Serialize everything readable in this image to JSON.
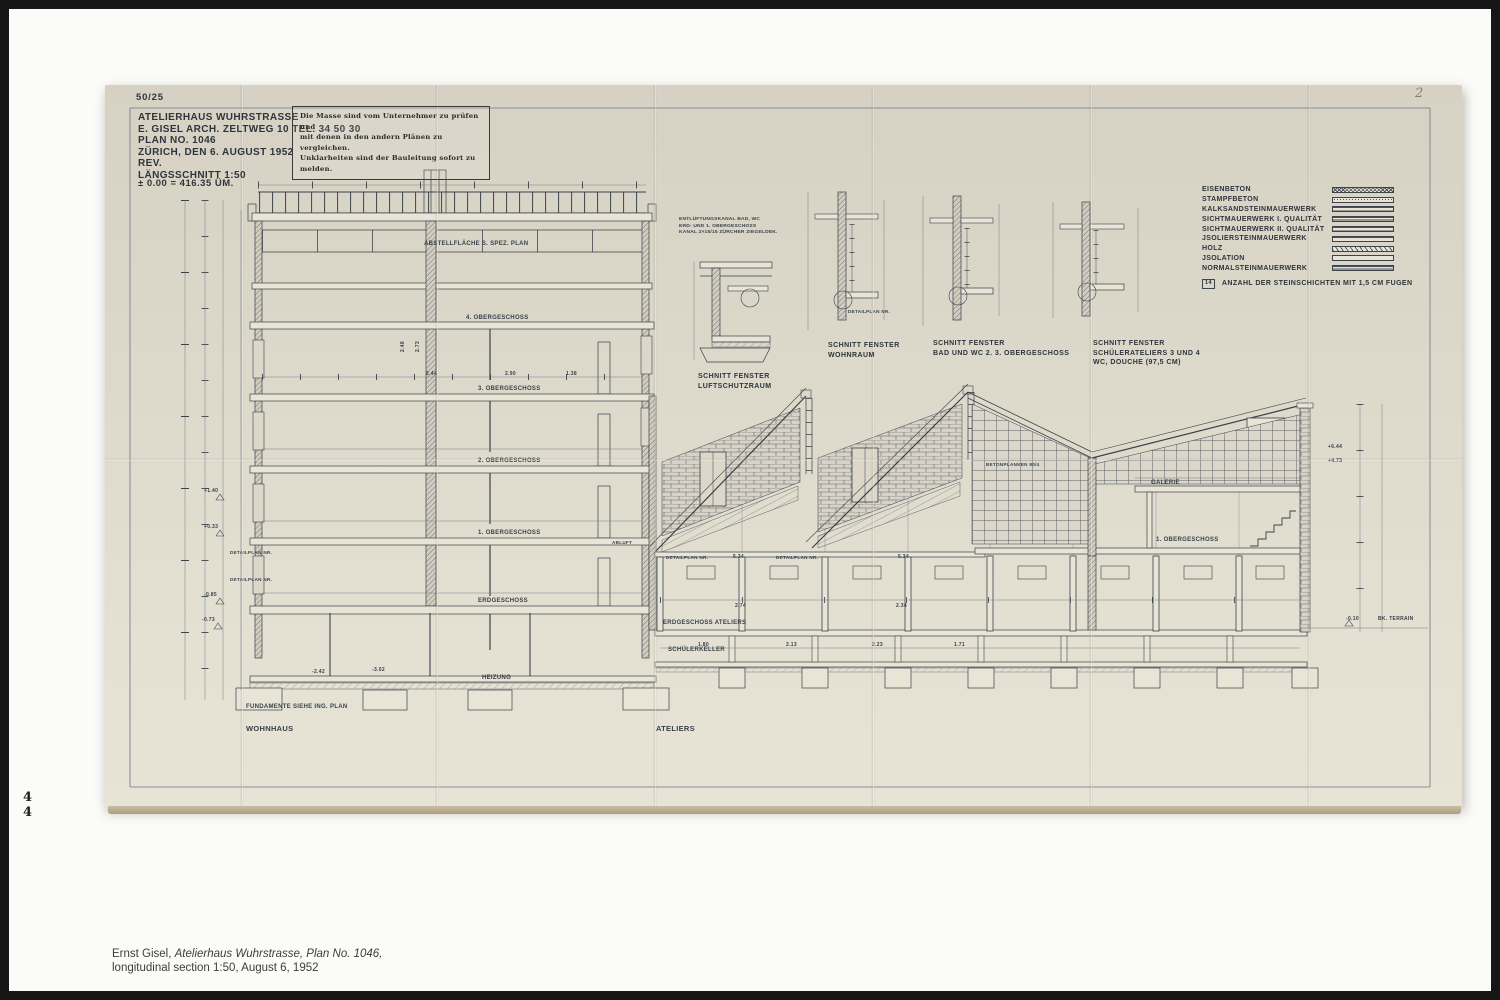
{
  "page": {
    "numbers": [
      "4",
      "4"
    ],
    "caption": {
      "author": "Ernst Gisel, ",
      "work_italic": "Atelierhaus Wuhrstrasse, Plan No. 1046,",
      "line2": "longitudinal section 1:50, August 6, 1952"
    }
  },
  "sheet": {
    "archive_no": "50/25",
    "corner_mark": "2",
    "title_block": {
      "lines": [
        "ATELIERHAUS WUHRSTRASSE",
        "E. GISEL ARCH. ZELTWEG 10    TEL. 34 50 30",
        "PLAN NO.  1046",
        "ZÜRICH, DEN   6. AUGUST  1952",
        "REV.",
        "LÄNGSSCHNITT   1:50"
      ],
      "datum": "± 0.00 = 416.35  ÜM."
    },
    "stamp": {
      "lines": [
        "Die Masse sind vom Unternehmer zu prüfen und",
        "mit denen in den andern Plänen zu vergleichen.",
        "Unklarheiten sind der Bauleitung sofort zu melden."
      ]
    },
    "legend": {
      "items": [
        {
          "label": "EISENBETON",
          "pattern": "cross"
        },
        {
          "label": "STAMPFBETON",
          "pattern": "stipple"
        },
        {
          "label": "KALKSANDSTEINMAUERWERK",
          "pattern": "h3"
        },
        {
          "label": "SICHTMAUERWERK   I. QUALITÄT",
          "pattern": "h2"
        },
        {
          "label": "SICHTMAUERWERK  II. QUALITÄT",
          "pattern": "h3"
        },
        {
          "label": "JSOLIERSTEINMAUERWERK",
          "pattern": "h4"
        },
        {
          "label": "HOLZ",
          "pattern": "diag"
        },
        {
          "label": "JSOLATION",
          "pattern": "blank"
        },
        {
          "label": "NORMALSTEINMAUERWERK",
          "pattern": "h2"
        }
      ],
      "note_badge": "14",
      "note": "ANZAHL  DER  STEINSCHICHTEN  MIT  1,5 CM   FUGEN"
    },
    "details": [
      {
        "title": "SCHNITT  FENSTER",
        "subtitle": "LUFTSCHUTZRAUM",
        "subtitle2": ""
      },
      {
        "title": "SCHNITT  FENSTER",
        "subtitle": "WOHNRAUM",
        "subtitle2": ""
      },
      {
        "title": "SCHNITT  FENSTER",
        "subtitle": "BAD UND WC  2. 3. OBERGESCHOSS",
        "subtitle2": ""
      },
      {
        "title": "SCHNITT  FENSTER",
        "subtitle": "SCHÜLERATELIERS  3 UND 4",
        "subtitle2": "WC, DOUCHE   (97,5 CM)"
      }
    ],
    "detail_note": {
      "lines": [
        "ENTLÜFTUNGSKANAL  BAD, WC",
        "ERD- UND 1. OBERGESCHOSS",
        "KANAL 2×15/15 ZÜRCHER ZIEGELDEK."
      ]
    },
    "annotations": [
      {
        "t": "ABSTELLFLÄCHE  S. SPEZ. PLAN",
        "x": 424,
        "y": 245,
        "s": 6
      },
      {
        "t": "4. OBERGESCHOSS",
        "x": 466,
        "y": 319,
        "s": 6
      },
      {
        "t": "3. OBERGESCHOSS",
        "x": 478,
        "y": 390,
        "s": 6
      },
      {
        "t": "2. OBERGESCHOSS",
        "x": 478,
        "y": 462,
        "s": 6
      },
      {
        "t": "1. OBERGESCHOSS",
        "x": 478,
        "y": 534,
        "s": 6
      },
      {
        "t": "ERDGESCHOSS",
        "x": 478,
        "y": 602,
        "s": 6
      },
      {
        "t": "FUNDAMENTE  SIEHE  ING. PLAN",
        "x": 246,
        "y": 708,
        "s": 6
      },
      {
        "t": "WOHNHAUS",
        "x": 246,
        "y": 731,
        "s": 7.5
      },
      {
        "t": "ATELIERS",
        "x": 656,
        "y": 731,
        "s": 7.5
      },
      {
        "t": "ERDGESCHOSS  ATELIERS",
        "x": 663,
        "y": 624,
        "s": 6
      },
      {
        "t": "SCHÜLERKELLER",
        "x": 668,
        "y": 651,
        "s": 6
      },
      {
        "t": "HEIZUNG",
        "x": 482,
        "y": 679,
        "s": 6
      },
      {
        "t": "GALERIE",
        "x": 1151,
        "y": 484,
        "s": 6
      },
      {
        "t": "1. OBERGESCHOSS",
        "x": 1156,
        "y": 541,
        "s": 6
      },
      {
        "t": "BETONPLANKEN  80/4",
        "x": 986,
        "y": 466,
        "s": 4.6
      },
      {
        "t": "DETAILPLAN NR.",
        "x": 230,
        "y": 554,
        "s": 4.6
      },
      {
        "t": "DETAILPLAN NR.",
        "x": 230,
        "y": 581,
        "s": 4.6
      },
      {
        "t": "DETAILPLAN NR.",
        "x": 666,
        "y": 559,
        "s": 4.6
      },
      {
        "t": "DETAILPLAN NR.",
        "x": 776,
        "y": 559,
        "s": 4.6
      },
      {
        "t": "DETAILPLAN NR.",
        "x": 848,
        "y": 313,
        "s": 4.6
      },
      {
        "t": "ABLUFT",
        "x": 612,
        "y": 544,
        "s": 4.6
      },
      {
        "t": "+1.40",
        "x": 204,
        "y": 492,
        "s": 5
      },
      {
        "t": "+0.33",
        "x": 204,
        "y": 528,
        "s": 5
      },
      {
        "t": "-0.85",
        "x": 204,
        "y": 596,
        "s": 5
      },
      {
        "t": "-0.73",
        "x": 202,
        "y": 621,
        "s": 5
      },
      {
        "t": "+6.44",
        "x": 1328,
        "y": 448,
        "s": 5
      },
      {
        "t": "+4.73",
        "x": 1328,
        "y": 462,
        "s": 5
      },
      {
        "t": "-0.10",
        "x": 1346,
        "y": 620,
        "s": 5
      },
      {
        "t": "BK. TERRAIN",
        "x": 1378,
        "y": 620,
        "s": 5
      },
      {
        "t": "2.44",
        "x": 426,
        "y": 375,
        "s": 5
      },
      {
        "t": "2.90",
        "x": 505,
        "y": 375,
        "s": 5
      },
      {
        "t": "1.38",
        "x": 566,
        "y": 375,
        "s": 5
      },
      {
        "t": "5.34",
        "x": 733,
        "y": 558,
        "s": 5
      },
      {
        "t": "5.34",
        "x": 898,
        "y": 558,
        "s": 5
      },
      {
        "t": "2.74",
        "x": 735,
        "y": 607,
        "s": 5
      },
      {
        "t": "2.34",
        "x": 896,
        "y": 607,
        "s": 5
      },
      {
        "t": "1.80",
        "x": 698,
        "y": 646,
        "s": 5
      },
      {
        "t": "2.13",
        "x": 786,
        "y": 646,
        "s": 5
      },
      {
        "t": "2.23",
        "x": 872,
        "y": 646,
        "s": 5
      },
      {
        "t": "1.71",
        "x": 954,
        "y": 646,
        "s": 5
      },
      {
        "t": "-2.42",
        "x": 312,
        "y": 673,
        "s": 5
      },
      {
        "t": "-3.02",
        "x": 372,
        "y": 671,
        "s": 5
      },
      {
        "t": "2.48",
        "x": 404,
        "y": 352,
        "s": 5,
        "r": -90
      },
      {
        "t": "2.73",
        "x": 419,
        "y": 352,
        "s": 5,
        "r": -90
      }
    ]
  }
}
